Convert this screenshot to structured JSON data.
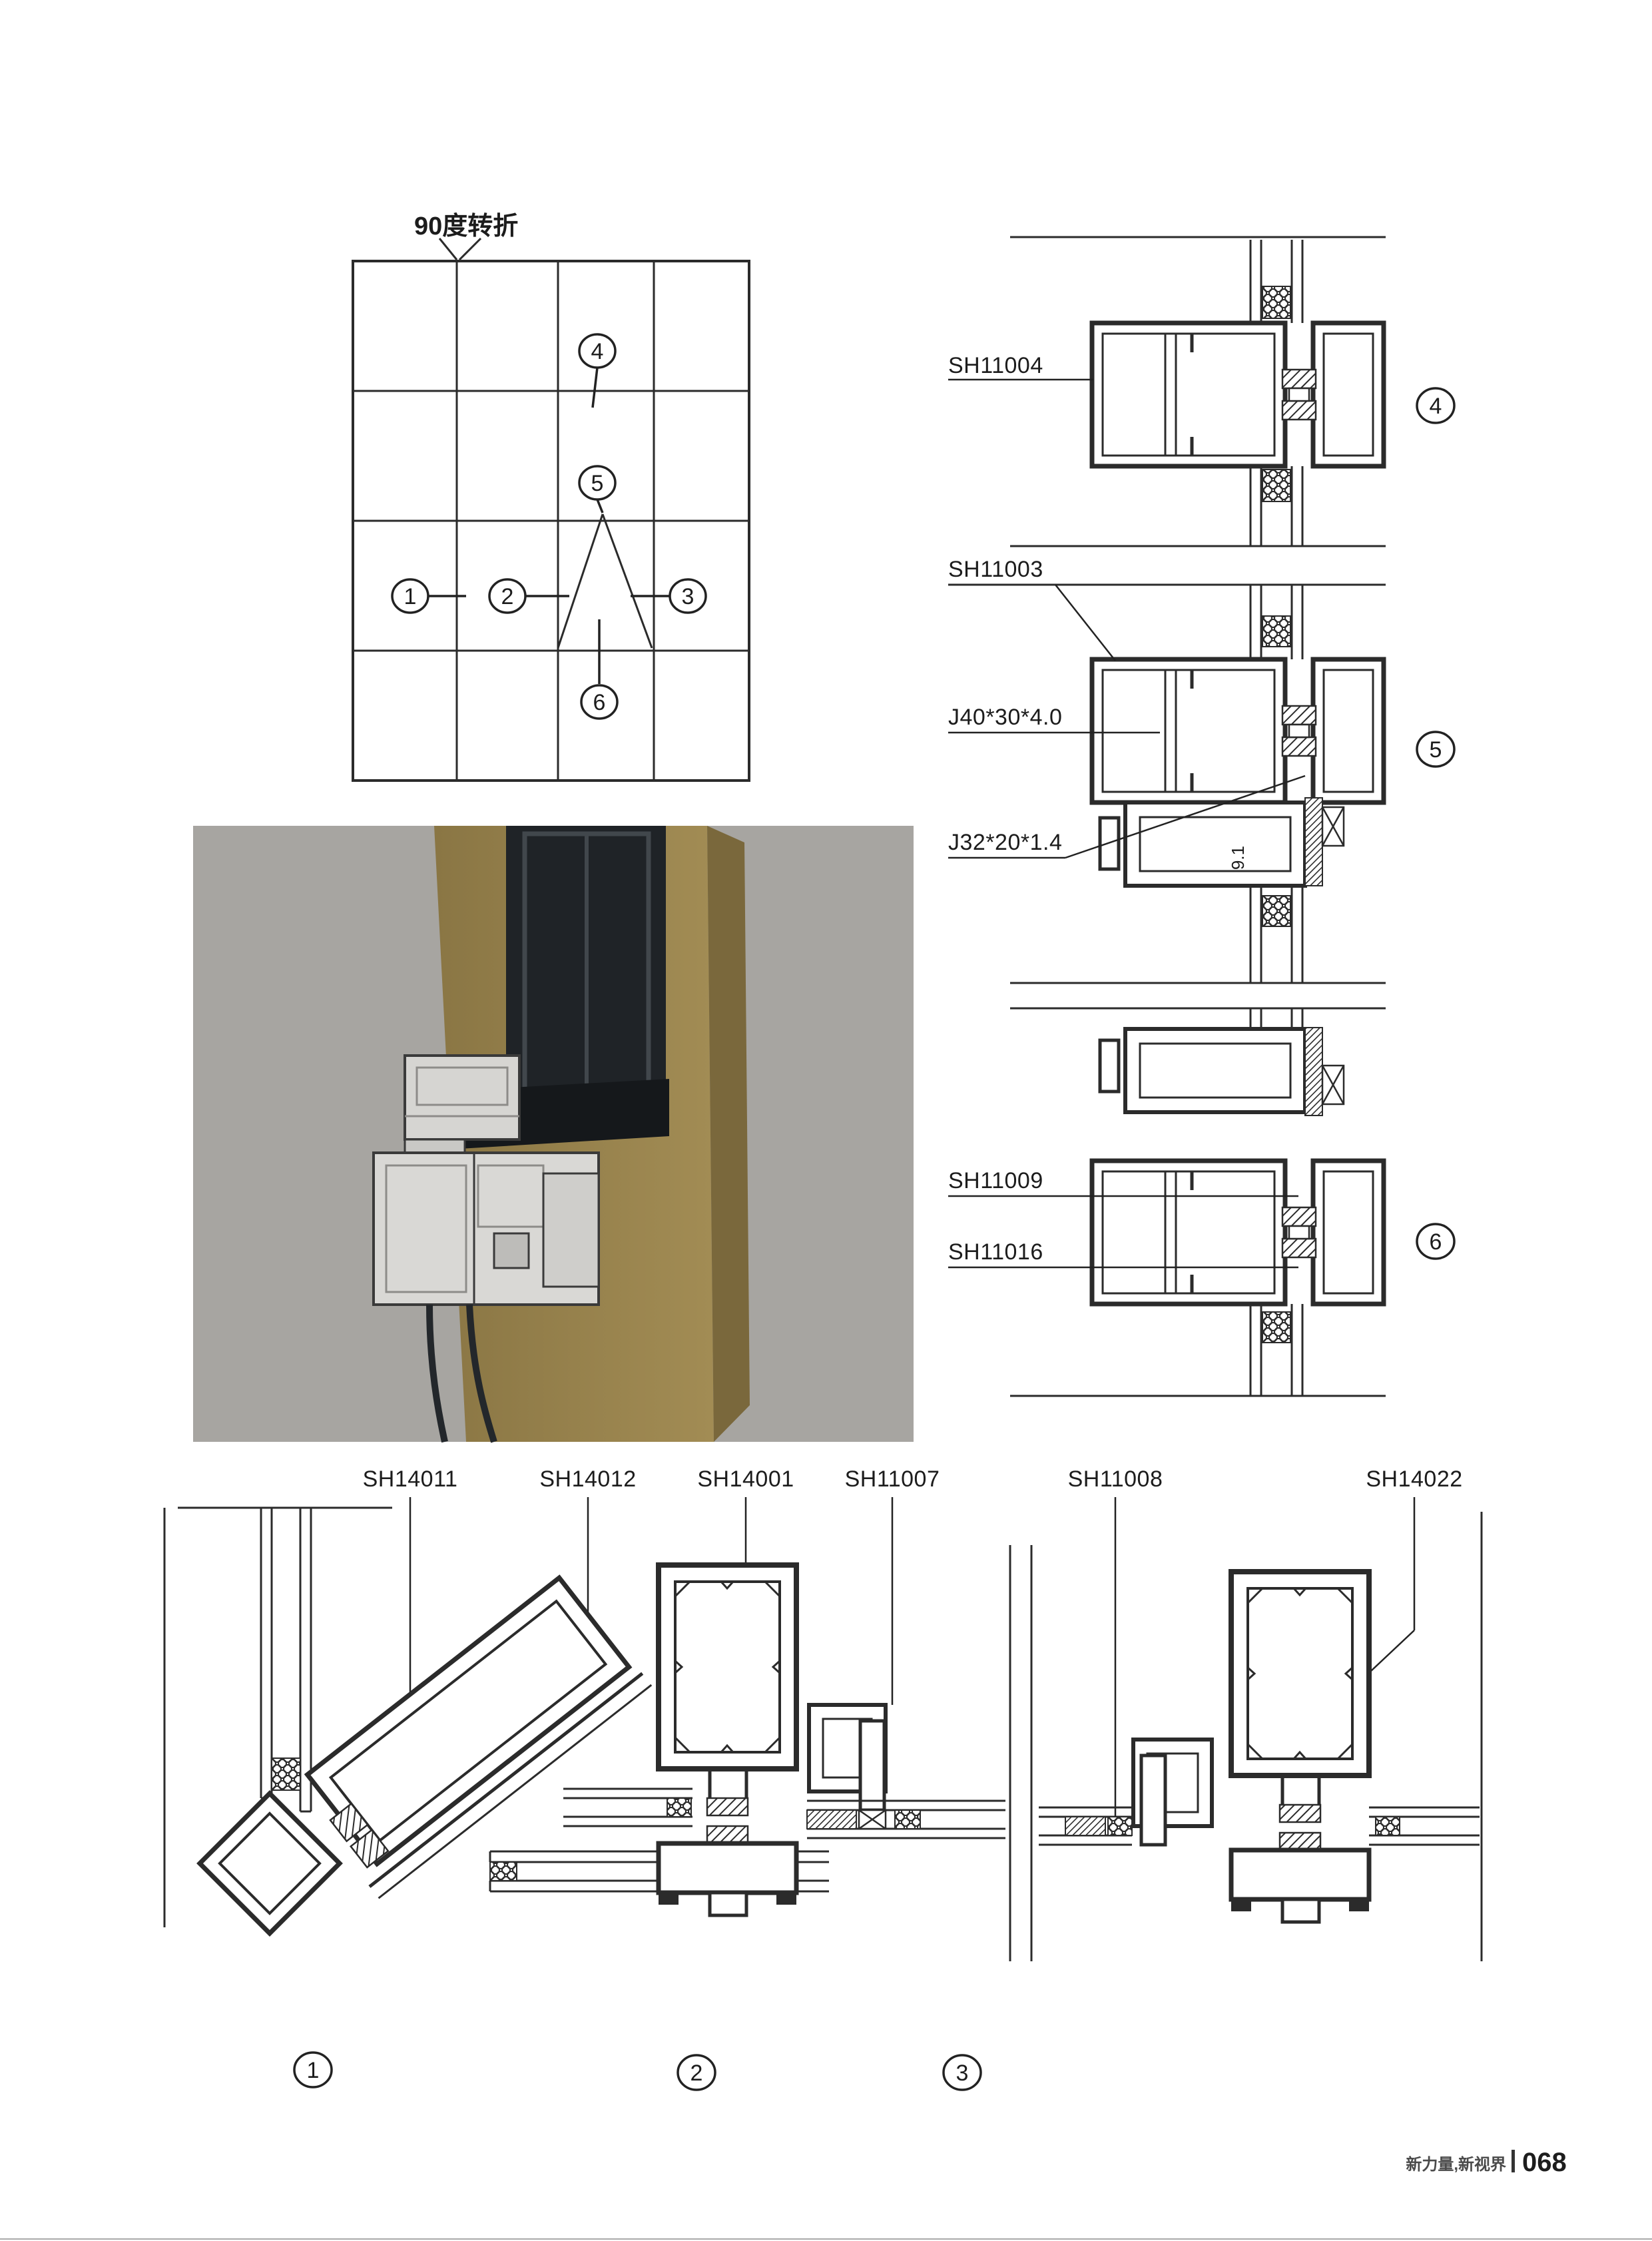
{
  "plan": {
    "title": "90度转折"
  },
  "callouts": {
    "c1": "1",
    "c2": "2",
    "c3": "3",
    "c4": "4",
    "c5": "5",
    "c6": "6"
  },
  "parts": {
    "sh11004": "SH11004",
    "sh11003": "SH11003",
    "j40": "J40*30*4.0",
    "j32": "J32*20*1.4",
    "dim91": "9.1",
    "sh11009": "SH11009",
    "sh11016": "SH11016",
    "sh14011": "SH14011",
    "sh14012": "SH14012",
    "sh14001": "SH14001",
    "sh11007": "SH11007",
    "sh11008": "SH11008",
    "sh14022": "SH14022"
  },
  "footer": {
    "brand": "新力量,新视界",
    "page": "068"
  },
  "colors": {
    "line": "#2b2b2b",
    "leader": "#333333",
    "photo_bg": "#a7a5a1",
    "bronze": "#97824e",
    "bronze_dark": "#7a683c",
    "glazing": "#22262a",
    "aluminum": "#d9d8d5",
    "footer_rule": "#aaaaaa"
  }
}
